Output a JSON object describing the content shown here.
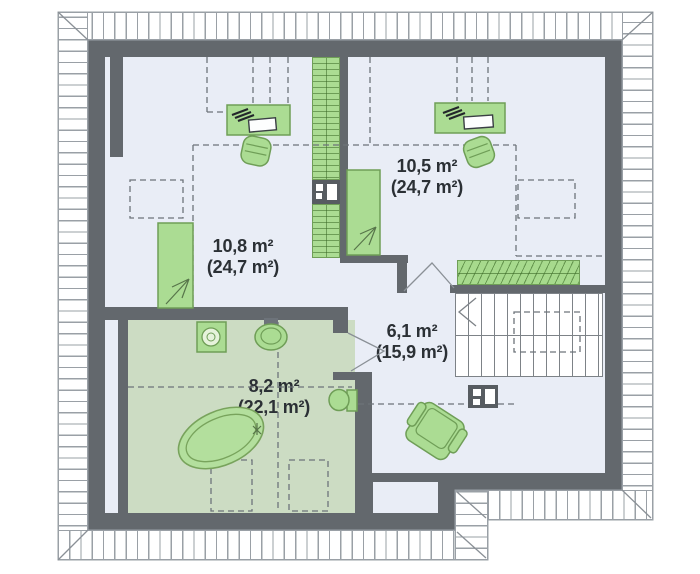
{
  "title": "attic-floor-plan",
  "rooms": [
    {
      "id": "bedroom-left",
      "area": "10,8 m²",
      "total_area": "(24,7 m²)"
    },
    {
      "id": "bedroom-right",
      "area": "10,5 m²",
      "total_area": "(24,7 m²)"
    },
    {
      "id": "hall",
      "area": "6,1 m²",
      "total_area": "(15,9 m²)"
    },
    {
      "id": "bathroom",
      "area": "8,2 m²",
      "total_area": "(22,1 m²)"
    }
  ],
  "colors": {
    "wall": "#63686d",
    "floor": "#e9edf6",
    "bathroom_floor": "#ccdcc3",
    "furniture_fill": "#abdc93",
    "furniture_stroke": "#6f9e57",
    "hatch_line": "#9aa0a6",
    "dash_line": "#6d737a",
    "stair_line": "#7d8287",
    "text": "#2b3035"
  },
  "furniture": [
    "wardrobe",
    "chest-of-drawers",
    "desk",
    "office-chair",
    "bed",
    "balustrade",
    "stairs",
    "chimney",
    "armchair",
    "washing-machine",
    "washbasin",
    "bathtub",
    "toilet"
  ]
}
